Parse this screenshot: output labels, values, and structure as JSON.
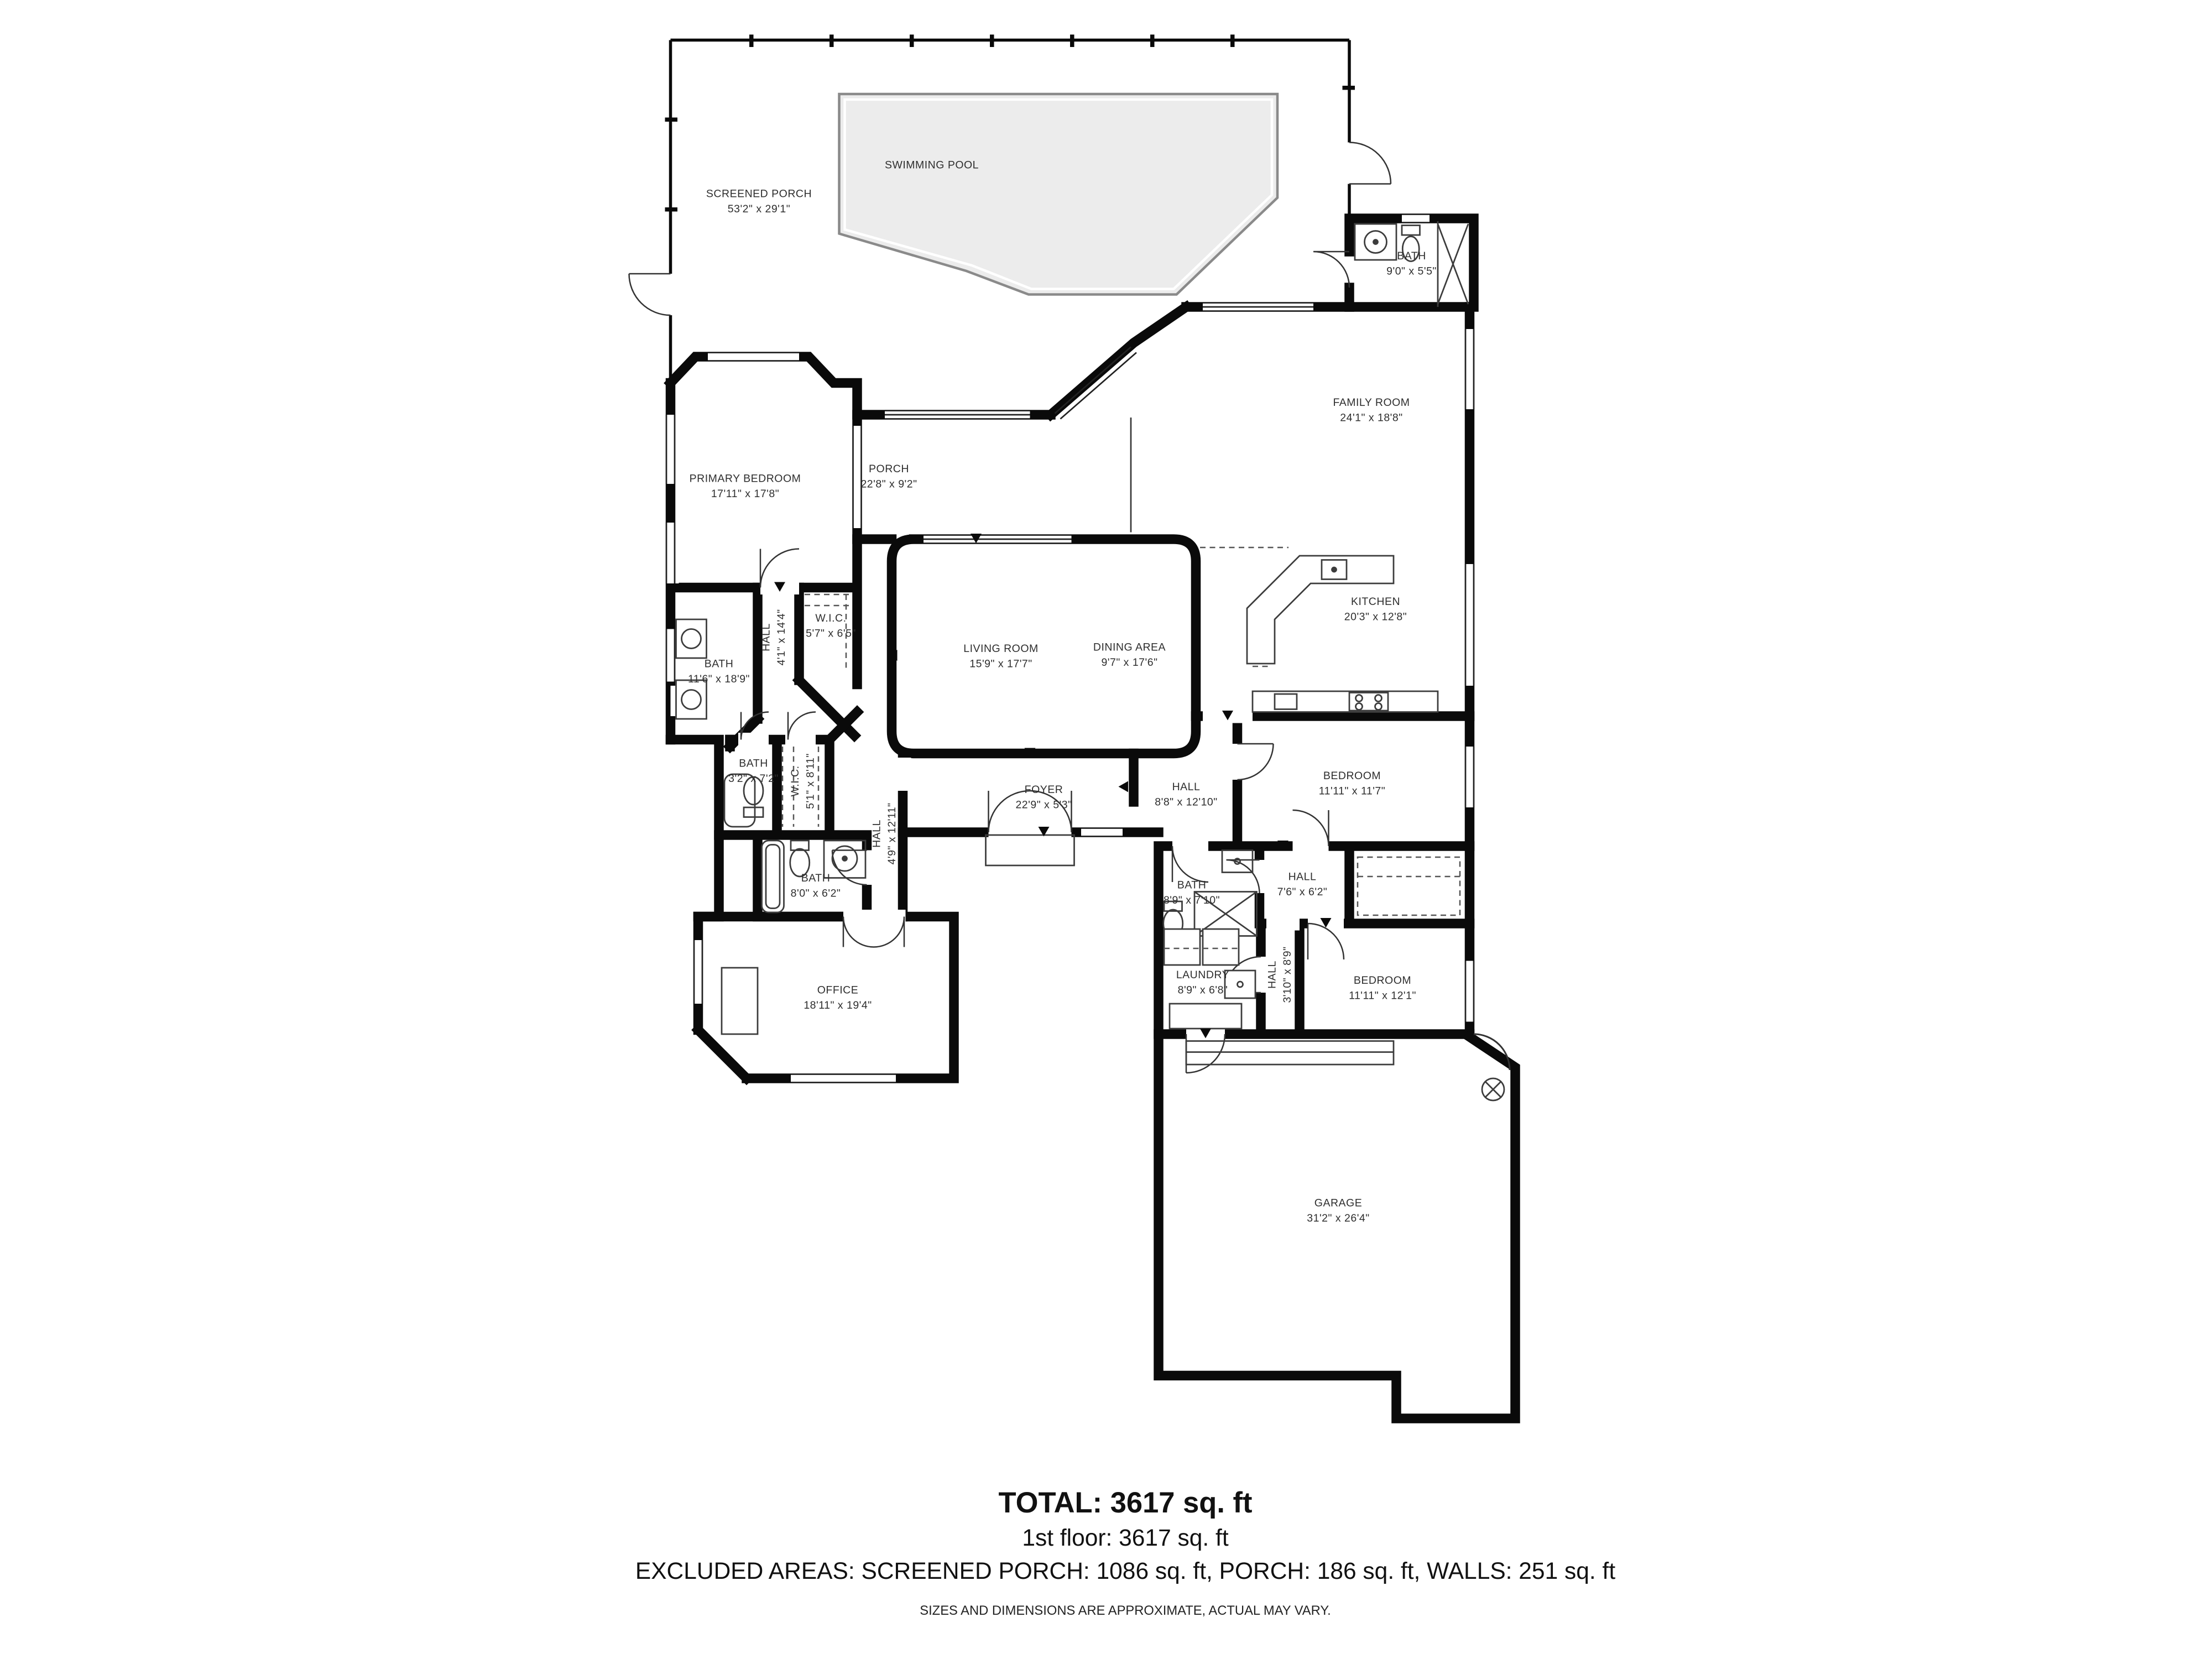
{
  "floor_plan": {
    "rooms": [
      {
        "id": "screened-porch",
        "name": "SCREENED PORCH",
        "dims": "53'2\" x 29'1\""
      },
      {
        "id": "swimming-pool",
        "name": "SWIMMING POOL",
        "dims": ""
      },
      {
        "id": "bath-pool",
        "name": "BATH",
        "dims": "9'0\" x 5'5\""
      },
      {
        "id": "family-room",
        "name": "FAMILY ROOM",
        "dims": "24'1\" x 18'8\""
      },
      {
        "id": "primary-bedroom",
        "name": "PRIMARY BEDROOM",
        "dims": "17'11\" x 17'8\""
      },
      {
        "id": "porch",
        "name": "PORCH",
        "dims": "22'8\" x 9'2\""
      },
      {
        "id": "kitchen",
        "name": "KITCHEN",
        "dims": "20'3\" x 12'8\""
      },
      {
        "id": "hall-primary",
        "name": "HALL",
        "dims": "4'1\" x 14'4\""
      },
      {
        "id": "wic-1",
        "name": "W.I.C.",
        "dims": "5'7\" x 6'5\""
      },
      {
        "id": "bath-primary",
        "name": "BATH",
        "dims": "11'6\" x 18'9\""
      },
      {
        "id": "living-room",
        "name": "LIVING ROOM",
        "dims": "15'9\" x 17'7\""
      },
      {
        "id": "dining-area",
        "name": "DINING AREA",
        "dims": "9'7\" x 17'6\""
      },
      {
        "id": "bath-toilet",
        "name": "BATH",
        "dims": "3'2\" x 7'2\""
      },
      {
        "id": "wic-2",
        "name": "W.I.C.",
        "dims": "5'1\" x 8'11\""
      },
      {
        "id": "foyer",
        "name": "FOYER",
        "dims": "22'9\" x 5'3\""
      },
      {
        "id": "hall-bedrooms",
        "name": "HALL",
        "dims": "8'8\" x 12'10\""
      },
      {
        "id": "bedroom-1",
        "name": "BEDROOM",
        "dims": "11'11\" x 11'7\""
      },
      {
        "id": "hall-office",
        "name": "HALL",
        "dims": "4'9\" x 12'11\""
      },
      {
        "id": "bath-hall",
        "name": "BATH",
        "dims": "8'0\" x 6'2\""
      },
      {
        "id": "bath-shower",
        "name": "BATH",
        "dims": "8'9\" x 7'10\""
      },
      {
        "id": "hall-middle",
        "name": "HALL",
        "dims": "7'6\" x 6'2\""
      },
      {
        "id": "office",
        "name": "OFFICE",
        "dims": "18'11\" x 19'4\""
      },
      {
        "id": "laundry",
        "name": "LAUNDRY",
        "dims": "8'9\" x 6'8\""
      },
      {
        "id": "hall-laundry",
        "name": "HALL",
        "dims": "3'10\" x 8'9\""
      },
      {
        "id": "bedroom-2",
        "name": "BEDROOM",
        "dims": "11'11\" x 12'1\""
      },
      {
        "id": "garage",
        "name": "GARAGE",
        "dims": "31'2\" x 26'4\""
      }
    ],
    "footer": {
      "total": "TOTAL: 3617 sq. ft",
      "first_floor": "1st floor: 3617 sq. ft",
      "excluded": "EXCLUDED AREAS: SCREENED PORCH: 1086 sq. ft, PORCH: 186 sq. ft, WALLS: 251 sq. ft",
      "disclaimer": "SIZES AND DIMENSIONS ARE APPROXIMATE, ACTUAL MAY VARY."
    },
    "colors": {
      "walls": "#0a0a0a",
      "pool_fill": "#ececec",
      "pool_outline": "#8a8a8a",
      "text": "#2e2e2e"
    }
  }
}
